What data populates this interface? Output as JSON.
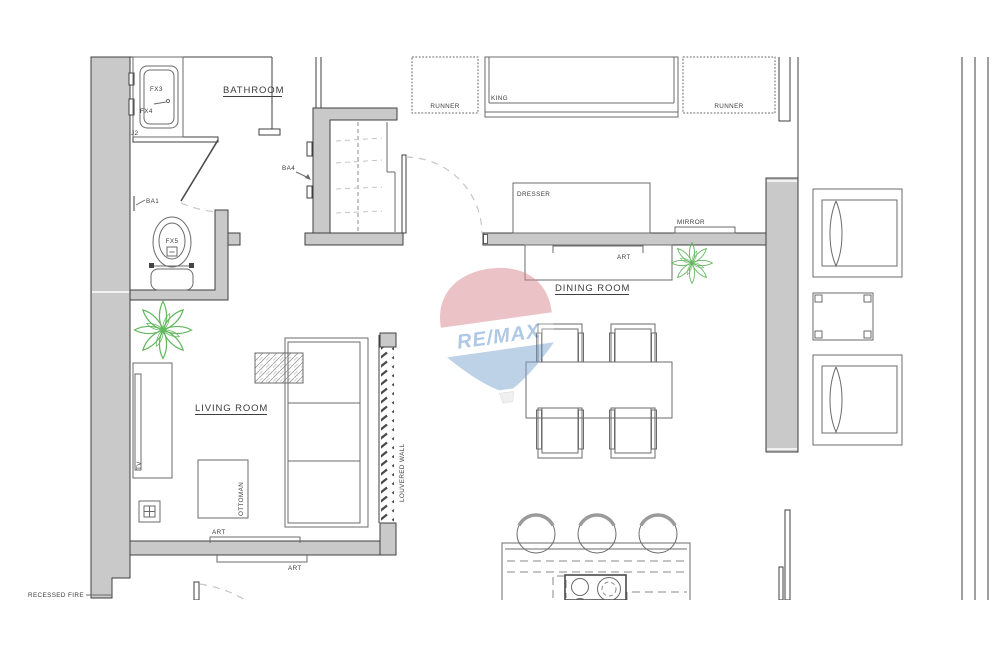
{
  "rooms": {
    "bathroom": "BATHROOM",
    "living": "LIVING ROOM",
    "dining": "DINING ROOM"
  },
  "fixtures": {
    "fx3": "FX3",
    "fx4": "FX4",
    "fx5": "FX5",
    "j2": "J2",
    "ba1": "BA1",
    "ba4": "BA4"
  },
  "furniture": {
    "runner_left": "RUNNER",
    "runner_right": "RUNNER",
    "king": "KING",
    "dresser": "DRESSER",
    "mirror": "MIRROR",
    "art_dining": "ART",
    "art_living": "ART",
    "art_hall": "ART",
    "tv": "TV",
    "ottoman": "OTTOMAN",
    "louvered_wall": "LOUVERED WALL",
    "recessed_fire": "RECESSED FIRE"
  },
  "watermark": {
    "brand": "RE/MAX"
  },
  "colors": {
    "wall_fill": "#c9c9c9",
    "line_dark": "#3f3f3f",
    "line_mid": "#6b6b6b",
    "plant_green": "#63b85f",
    "remax_red": "#d9888f",
    "remax_blue": "#7fa6d0",
    "remax_text": "#5f93cc"
  }
}
